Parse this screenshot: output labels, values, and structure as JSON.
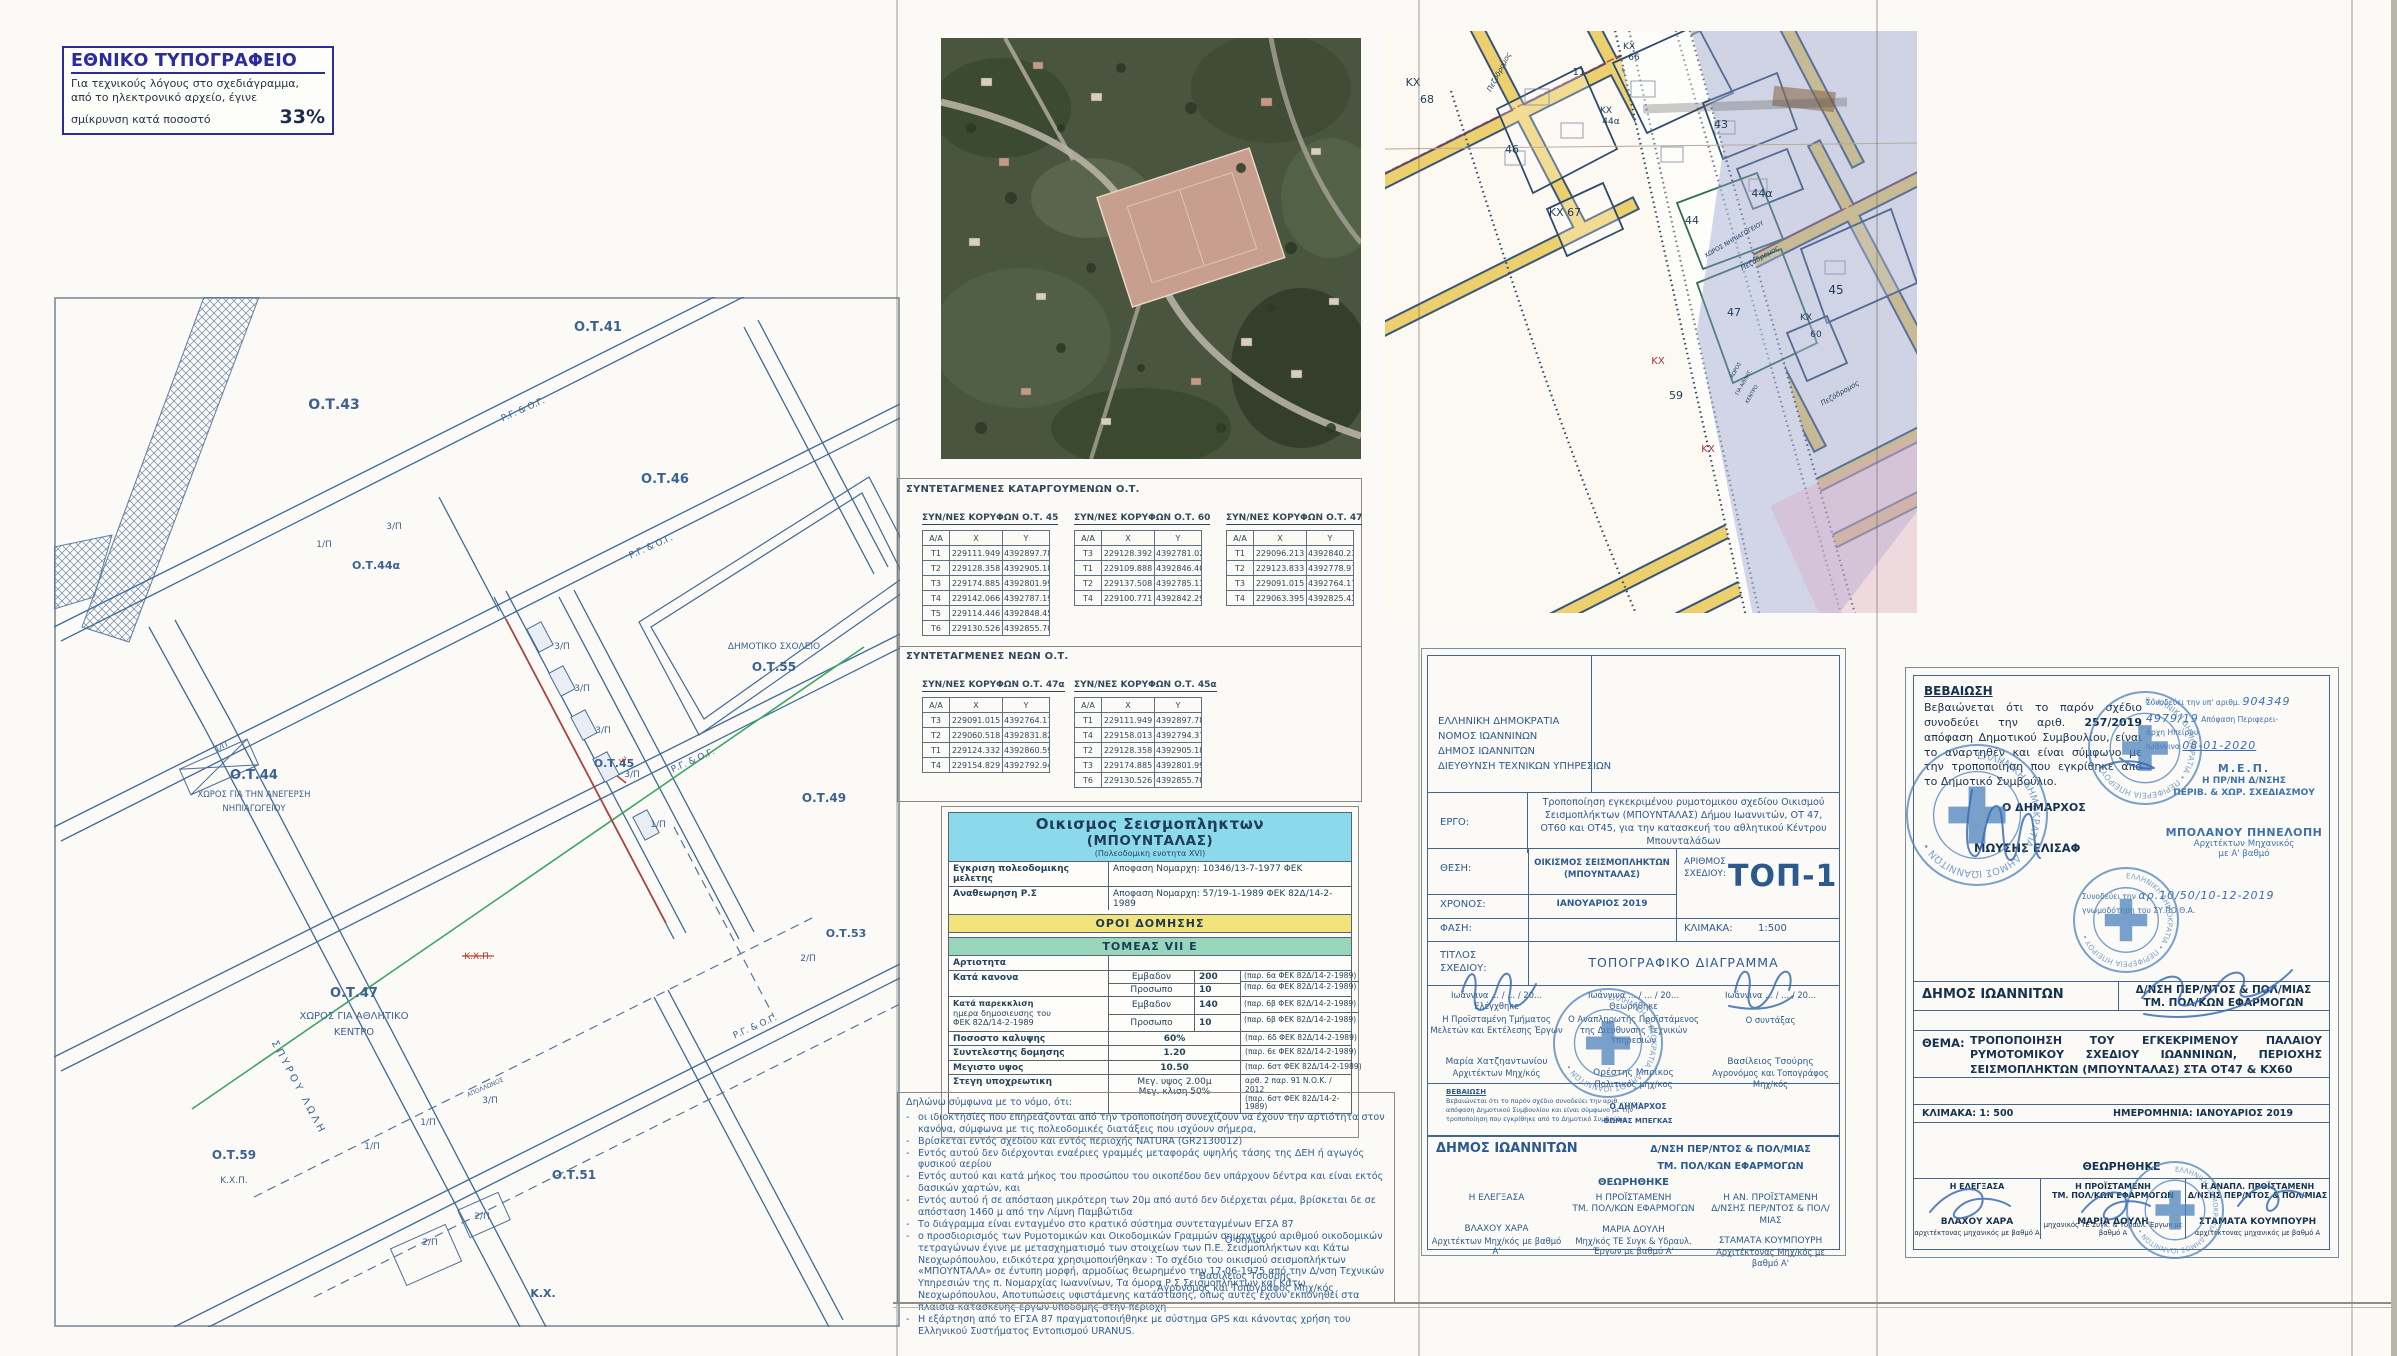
{
  "colors": {
    "ink_blue": "#2d5a8e",
    "drawing_line": "#3f6a96",
    "navy": "#16324f",
    "stamp_blue": "#4d83bd",
    "band_cyan": "#8bd9ea",
    "band_yellow": "#f3e37b",
    "band_green": "#97d6ba",
    "accent_red": "#c0392f",
    "old_map_road_yellow": "#ecd06e",
    "old_map_wash_blue": "#8f9ccc",
    "aerial_green": "#49553e"
  },
  "stamp_note": {
    "title": "ΕΘΝΙΚΟ ΤΥΠΟΓΡΑΦΕΙΟ",
    "line1": "Για τεχνικούς λόγους στο σχεδιάγραμμα,",
    "line2": "από το ηλεκτρονικό αρχείο, έγινε",
    "line3": "σμίκρυνση κατά ποσοστό",
    "percent": "33%"
  },
  "map_left": {
    "labels": [
      {
        "t": "Ο.Τ.43",
        "x": 280,
        "y": 112,
        "s": 14,
        "b": 1
      },
      {
        "t": "Ο.Τ.41",
        "x": 544,
        "y": 34,
        "s": 13,
        "b": 1
      },
      {
        "t": "Ο.Τ.46",
        "x": 611,
        "y": 186,
        "s": 13,
        "b": 1
      },
      {
        "t": "Ο.Τ.44α",
        "x": 322,
        "y": 272,
        "s": 11,
        "b": 1
      },
      {
        "t": "1/Π",
        "x": 270,
        "y": 250,
        "s": 9
      },
      {
        "t": "3/Π",
        "x": 340,
        "y": 232,
        "s": 9
      },
      {
        "t": "Ρ.Γ. & Ο.Γ.",
        "x": 470,
        "y": 115,
        "s": 9,
        "r": -24
      },
      {
        "t": "Ρ.Γ. & Ο.Γ.",
        "x": 598,
        "y": 252,
        "s": 9,
        "r": -24
      },
      {
        "t": "Ρ.Γ. & Ο.Γ.",
        "x": 640,
        "y": 466,
        "s": 9,
        "r": -24
      },
      {
        "t": "Ρ.Γ. & Ο.Γ.",
        "x": 702,
        "y": 732,
        "s": 9,
        "r": -24
      },
      {
        "t": "Ο.Τ.44",
        "x": 200,
        "y": 482,
        "s": 13,
        "b": 1
      },
      {
        "t": "ΧΩΡΟΣ ΓΙΑ ΤΗΝ ΑΝΕΓΕΡΣΗ",
        "x": 200,
        "y": 500,
        "s": 8.5
      },
      {
        "t": "ΝΗΠΙΑΓΩΓΕΙΟΥ",
        "x": 200,
        "y": 514,
        "s": 8.5
      },
      {
        "t": "1/Π",
        "x": 168,
        "y": 452,
        "s": 8,
        "r": -24
      },
      {
        "t": "Ο.Τ.45",
        "x": 560,
        "y": 470,
        "s": 11,
        "b": 1
      },
      {
        "t": "3/Π",
        "x": 508,
        "y": 352,
        "s": 9
      },
      {
        "t": "3/Π",
        "x": 528,
        "y": 394,
        "s": 9
      },
      {
        "t": "3/Π",
        "x": 549,
        "y": 436,
        "s": 9
      },
      {
        "t": "3/Π",
        "x": 578,
        "y": 480,
        "s": 9
      },
      {
        "t": "1/Π",
        "x": 604,
        "y": 530,
        "s": 9
      },
      {
        "t": "ΔΗΜΟΤΙΚΟ ΣΧΟΛΕΙΟ",
        "x": 720,
        "y": 352,
        "s": 9
      },
      {
        "t": "Ο.Τ.55",
        "x": 720,
        "y": 374,
        "s": 12,
        "b": 1
      },
      {
        "t": "Ο.Τ.49",
        "x": 770,
        "y": 505,
        "s": 12,
        "b": 1
      },
      {
        "t": "Ο.Τ.47",
        "x": 300,
        "y": 700,
        "s": 13,
        "b": 1
      },
      {
        "t": "ΧΩΡΟΣ ΓΙΑ ΑΘΛΗΤΙΚΟ",
        "x": 300,
        "y": 722,
        "s": 10
      },
      {
        "t": "ΚΕΝΤΡΟ",
        "x": 300,
        "y": 738,
        "s": 10
      },
      {
        "t": "Κ.Χ.Π.",
        "x": 424,
        "y": 662,
        "s": 9,
        "c": "#c0392f",
        "strike": 1
      },
      {
        "t": "3",
        "x": 566,
        "y": 464,
        "s": 9,
        "c": "#c0392f",
        "r": 62
      },
      {
        "t": "Ο.Τ.53",
        "x": 792,
        "y": 640,
        "s": 11,
        "b": 1
      },
      {
        "t": "2/Π",
        "x": 754,
        "y": 664,
        "s": 9
      },
      {
        "t": "Ο.Τ.51",
        "x": 520,
        "y": 882,
        "s": 12,
        "b": 1
      },
      {
        "t": "Ο.Τ.59",
        "x": 180,
        "y": 862,
        "s": 12,
        "b": 1
      },
      {
        "t": "Κ.Χ.Π.",
        "x": 180,
        "y": 886,
        "s": 9
      },
      {
        "t": "ΣΠΥΡΟΥ ΛΩΛΗ",
        "x": 242,
        "y": 792,
        "s": 10,
        "r": 62,
        "ls": 3
      },
      {
        "t": "ΑΠΟΛΛΩΝΟΣ",
        "x": 432,
        "y": 792,
        "s": 6,
        "r": -24
      },
      {
        "t": "1/Π",
        "x": 318,
        "y": 852,
        "s": 9
      },
      {
        "t": "1/Π",
        "x": 374,
        "y": 828,
        "s": 9
      },
      {
        "t": "3/Π",
        "x": 436,
        "y": 806,
        "s": 9
      },
      {
        "t": "2/Π",
        "x": 376,
        "y": 948,
        "s": 9
      },
      {
        "t": "2/Π",
        "x": 428,
        "y": 922,
        "s": 9
      },
      {
        "t": "Κ.Χ.",
        "x": 489,
        "y": 1000,
        "s": 11,
        "b": 1
      }
    ]
  },
  "map_old": {
    "labels": [
      {
        "t": "ΚΧ",
        "x": 28,
        "y": 55,
        "s": 11
      },
      {
        "t": "68",
        "x": 42,
        "y": 72,
        "s": 11
      },
      {
        "t": "ΚΧ",
        "x": 244,
        "y": 18,
        "s": 9
      },
      {
        "t": "66",
        "x": 249,
        "y": 29,
        "s": 9
      },
      {
        "t": "11",
        "x": 194,
        "y": 44,
        "s": 10
      },
      {
        "t": "ΚΧ",
        "x": 221,
        "y": 82,
        "s": 9
      },
      {
        "t": "44α",
        "x": 226,
        "y": 93,
        "s": 9
      },
      {
        "t": "43",
        "x": 336,
        "y": 97,
        "s": 11
      },
      {
        "t": "46",
        "x": 127,
        "y": 122,
        "s": 11
      },
      {
        "t": "ΚΧ 67",
        "x": 180,
        "y": 185,
        "s": 11
      },
      {
        "t": "44α",
        "x": 377,
        "y": 166,
        "s": 11
      },
      {
        "t": "44",
        "x": 307,
        "y": 193,
        "s": 11
      },
      {
        "t": "ΧΩΡΟΣ ΝΗΠΙΑΓΩΓΕΙΟΥ",
        "x": 350,
        "y": 210,
        "s": 6,
        "r": -30
      },
      {
        "t": "Πεζόδρομος",
        "x": 116,
        "y": 42,
        "s": 7,
        "r": -62,
        "i": 1
      },
      {
        "t": "Πεζόδρομος",
        "x": 376,
        "y": 229,
        "s": 7,
        "r": -30,
        "i": 1
      },
      {
        "t": "Πεζόδρομος",
        "x": 456,
        "y": 364,
        "s": 7,
        "r": -30,
        "i": 1
      },
      {
        "t": "45",
        "x": 451,
        "y": 263,
        "s": 12
      },
      {
        "t": "47",
        "x": 349,
        "y": 285,
        "s": 11
      },
      {
        "t": "ΚΧ",
        "x": 273,
        "y": 333,
        "s": 10,
        "c": "#a83240"
      },
      {
        "t": "59",
        "x": 291,
        "y": 368,
        "s": 11
      },
      {
        "t": "ΚΧ",
        "x": 323,
        "y": 421,
        "s": 10,
        "c": "#a83240"
      },
      {
        "t": "ΚΧ",
        "x": 421,
        "y": 289,
        "s": 9
      },
      {
        "t": "60",
        "x": 431,
        "y": 306,
        "s": 9
      },
      {
        "t": "ΧΩΡΟΣ",
        "x": 352,
        "y": 340,
        "s": 5,
        "r": -60
      },
      {
        "t": "ΓΙΑ ΑΘΛΗΤ.",
        "x": 360,
        "y": 352,
        "s": 5,
        "r": -60
      },
      {
        "t": "ΚΕΝΤΡΟ",
        "x": 368,
        "y": 364,
        "s": 5,
        "r": -60
      }
    ]
  },
  "coords": {
    "title_removed": "ΣΥΝΤΕΤΑΓΜΕΝΕΣ ΚΑΤΑΡΓΟΥΜΕΝΩΝ Ο.Τ.",
    "title_new": "ΣΥΝΤΕΤΑΓΜΕΝΕΣ ΝΕΩΝ Ο.Τ.",
    "headers": [
      "Α/Α",
      "Χ",
      "Υ"
    ],
    "removed": [
      {
        "title": "ΣΥΝ/ΝΕΣ ΚΟΡΥΦΩΝ Ο.Τ. 45",
        "rows": [
          [
            "Τ1",
            "229111.949",
            "4392897.789"
          ],
          [
            "Τ2",
            "229128.358",
            "4392905.187"
          ],
          [
            "Τ3",
            "229174.885",
            "4392801.991"
          ],
          [
            "Τ4",
            "229142.066",
            "4392787.194"
          ],
          [
            "Τ5",
            "229114.446",
            "4392848.455"
          ],
          [
            "Τ6",
            "229130.526",
            "4392855.705"
          ]
        ]
      },
      {
        "title": "ΣΥΝ/ΝΕΣ ΚΟΡΥΦΩΝ Ο.Τ. 60",
        "rows": [
          [
            "Τ3",
            "229128.392",
            "4392781.029"
          ],
          [
            "Τ1",
            "229109.888",
            "4392846.400"
          ],
          [
            "Τ2",
            "229137.508",
            "4392785.139"
          ],
          [
            "Τ4",
            "229100.771",
            "4392842.290"
          ]
        ]
      },
      {
        "title": "ΣΥΝ/ΝΕΣ ΚΟΡΥΦΩΝ Ο.Τ. 47",
        "rows": [
          [
            "Τ1",
            "229096.213",
            "4392840.235"
          ],
          [
            "Τ2",
            "229123.833",
            "4392778.974"
          ],
          [
            "Τ3",
            "229091.015",
            "4392764.177"
          ],
          [
            "Τ4",
            "229063.395",
            "4392825.439"
          ]
        ]
      }
    ],
    "new": [
      {
        "title": "ΣΥΝ/ΝΕΣ ΚΟΡΥΦΩΝ Ο.Τ. 47α",
        "rows": [
          [
            "Τ3",
            "229091.015",
            "4392764.177"
          ],
          [
            "Τ2",
            "229060.518",
            "4392831.820"
          ],
          [
            "Τ1",
            "229124.332",
            "4392860.591"
          ],
          [
            "Τ4",
            "229154.829",
            "4392792.948"
          ]
        ]
      },
      {
        "title": "ΣΥΝ/ΝΕΣ ΚΟΡΥΦΩΝ Ο.Τ. 45α",
        "rows": [
          [
            "Τ1",
            "229111.949",
            "4392897.789"
          ],
          [
            "Τ4",
            "229158.013",
            "4392794.376"
          ],
          [
            "Τ2",
            "229128.358",
            "4392905.187"
          ],
          [
            "Τ3",
            "229174.885",
            "4392801.991"
          ],
          [
            "Τ6",
            "229130.526",
            "4392855.705"
          ]
        ]
      }
    ]
  },
  "oroi": {
    "title1": "Οικισμος Σεισμοπληκτων",
    "title2": "(ΜΠΟΥΝΤΑΛΑΣ)",
    "title3": "(Πολεοδομικη ενοτητα XVI)",
    "appr1_label": "Εγκριση πολεοδομικης μελετης",
    "appr1_value": "Αποφαση Νομαρχη: 10346/13-7-1977  ΦΕΚ",
    "appr2_label": "Αναθεωρηση Ρ.Σ",
    "appr2_value": "Αποφαση Νομαρχη: 57/19-1-1989  ΦΕΚ 82Δ/14-2-1989",
    "band_terms": "ΟΡΟΙ ΔΟΜΗΣΗΣ",
    "band_sector": "ΤΟΜΕΑΣ  VII Ε",
    "artiotita": "Αρτιοτητα",
    "kanona_label": "Κατά  κανονα",
    "kan_r1": [
      "Εμβαδον",
      "200",
      "(παρ. 6α ΦΕΚ 82Δ/14-2-1989)"
    ],
    "kan_r2": [
      "Προσωπο",
      "10",
      "(παρ. 6α ΦΕΚ 82Δ/14-2-1989)"
    ],
    "par_label1": "Κατά  παρεκκλιση",
    "par_label2": "ημερα δημοσιευσης του",
    "par_label3": "ΦΕΚ  82Δ/14-2-1989",
    "par_r1": [
      "Εμβαδον",
      "140",
      "(παρ. 6β ΦΕΚ 82Δ/14-2-1989)"
    ],
    "par_r2": [
      "Προσωπο",
      "10",
      "(παρ. 6β ΦΕΚ 82Δ/14-2-1989)"
    ],
    "row_cover": [
      "Ποσοστο καλυψης",
      "60%",
      "(παρ. 6δ ΦΕΚ 82Δ/14-2-1989)"
    ],
    "row_sd": [
      "Συντελεστης  δομησης",
      "1.20",
      "(παρ. 6ε ΦΕΚ 82Δ/14-2-1989)"
    ],
    "row_height": [
      "Μεγιστο υψος",
      "10.50",
      "(παρ. 6στ ΦΕΚ 82Δ/14-2-1989)"
    ],
    "roof_label": "Στεγη υποχρεωτικη",
    "roof_mid1": "Μεγ.  υψος 2.00μ",
    "roof_mid2": "Μεγ.  κλιση  50%",
    "roof_cite1": "αρθ. 2  παρ. 91 Ν.Ο.Κ. / 2012",
    "roof_cite2": "(παρ. 6στ ΦΕΚ 82Δ/14-2-1989)"
  },
  "declaration": {
    "intro": "Δηλώνω σύμφωνα με το νόμο, ότι:",
    "bullets": [
      "οι ιδιοκτησίες που επηρεάζονται από την τροποποίηση συνεχίζουν να έχουν την αρτιότητα στον κανόνα, σύμφωνα με τις πολεοδομικές διατάξεις που ισχύουν σήμερα,",
      "Βρίσκεται εντός σχεδίου και εντός περιοχής NATURA (GR2130012)",
      "Εντός αυτού δεν διέρχονται εναέριες γραμμές μεταφοράς υψηλής τάσης της ΔΕΗ ή αγωγός φυσικού αερίου",
      "Εντός αυτού και κατά μήκος του προσώπου του οικοπέδου δεν υπάρχουν δέντρα και είναι εκτός δασικών χαρτών, και",
      "Εντός αυτού ή σε απόσταση μικρότερη των 20μ από αυτό δεν διέρχεται ρέμα, βρίσκεται δε σε απόσταση 1460 μ από την Λίμνη Παμβώτιδα",
      "Το διάγραμμα είναι ενταγμένο στο κρατικό σύστημα συντεταγμένων ΕΓΣΑ 87",
      "ο προσδιορισμός των Ρυμοτομικών και Οικοδομικών Γραμμών σημαντικού αριθμού οικοδομικών τετραγώνων έγινε με μετασχηματισμό των στοιχείων των Π.Ε. Σεισμοπλήκτων και Κάτω Νεοχωρόπουλου, ειδικότερα χρησιμοποιήθηκαν : Το σχέδιο του οικισμού σεισμοπλήκτων «ΜΠΟΥΝΤΑΛΑ» σε έντυπη μορφή, αρμοδίως θεωρημένο την 17-06-1975 από την Δ/νση Τεχνικών Υπηρεσιών της π. Νομαρχίας Ιωαννίνων, Τα όμορα Ρ.Σ Σεισμοπλήκτων και Κάτω Νεοχωρόπουλου, Αποτυπώσεις υφιστάμενης κατάστασης, όπως αυτές έχουν εκπονηθεί στα πλαίσια κατασκευής έργων υποδομής στην περιοχή",
      "Η εξάρτηση από το ΕΓΣΑ 87 πραγματοποιήθηκε με σύστημα GPS και κάνοντας χρήση του Ελληνικού Συστήματος Εντοπισμού URANUS."
    ],
    "signoff": "Ο δηλών",
    "signer_name": "Βασιλειος Τσούρης",
    "signer_title": "Αγρονόμος και Τοπογράφος   Μηχ/κός"
  },
  "titleblock": {
    "agency0": "ΕΛΛΗΝΙΚΗ ΔΗΜΟΚΡΑΤΙΑ",
    "agency1": "ΝΟΜΟΣ ΙΩΑΝΝΙΝΩΝ",
    "agency2": "ΔΗΜΟΣ ΙΩΑΝΝΙΤΩΝ",
    "agency3": "ΔΙΕΥΘΥΝΣΗ ΤΕΧΝΙΚΩΝ ΥΠΗΡΕΣΙΩΝ",
    "ergo_label": "ΕΡΓΟ:",
    "ergo_text": "Τροποποίηση εγκεκριμένου ρυμοτομικου σχεδίου Οικισμού Σεισμοπλήκτων (ΜΠΟΥΝΤΑΛΑΣ) Δήμου Ιωαννιτών, ΟΤ 47, ΟΤ60 και ΟΤ45, για την κατασκευή του αθλητικού Κέντρου Μπουνταλάδων",
    "thesi_label": "ΘΕΣΗ:",
    "thesi_text1": "ΟΙΚΙΣΜΟΣ ΣΕΙΣΜΟΠΛΗΚΤΩΝ",
    "thesi_text2": "(ΜΠΟΥΝΤΑΛΑΣ)",
    "num_label1": "ΑΡΙΘΜΟΣ",
    "num_label2": "ΣΧΕΔΙΟΥ:",
    "num_value": "ΤΟΠ-1",
    "xronos_label": "ΧΡΟΝΟΣ:",
    "xronos_value": "ΙΑΝΟΥΑΡΙΟΣ 2019",
    "fasi_label": "ΦΑΣΗ:",
    "klimaka_label": "ΚΛΙΜΑΚΑ:",
    "klimaka_value": "1:500",
    "titlos_label1": "ΤΙΤΛΟΣ",
    "titlos_label2": "ΣΧΕΔΙΟΥ:",
    "titlos_value": "ΤΟΠΟΓΡΑΦΙΚΟ ΔΙΑΓΡΑΜΜΑ",
    "sig_cols": [
      {
        "place": "Ιωάννινα  ... / ... / 20...",
        "status": "Ελέγχθηκε",
        "role1": "Η Προϊσταμένη Τμήματος",
        "role2": "Μελετών και Εκτέλεσης Έργων",
        "name": "Μαρία Χατζηαντωνίου",
        "title": "Αρχιτέκτων  Μηχ/κός"
      },
      {
        "place": "Ιωάννινα  ... / ... / 20...",
        "status": "Θεωρήθηκε",
        "role1": "Ο Αναπληρωτής Προϊστάμενος",
        "role2": "της Διεύθυνσης Τεχνικών Υπηρεσιών",
        "name": "Ορέστης Μπρίκος",
        "title": "Πολιτικός  μηχ/κος"
      },
      {
        "place": "Ιωάννινα  ... / ... / 20...",
        "status": "",
        "role1": "",
        "role2": "Ο συντάξας",
        "name": "Βασίλειος Τσούρης",
        "title": "Αγρονόμος και Τοπογράφος Μηχ/κός"
      }
    ],
    "vev_small_title": "ΒΕΒΑΙΩΣΗ",
    "vev_small_l1": "Βεβαιώνεται ότι το παρόν σχέδιο συνοδεύει την αριθ. ..........",
    "vev_small_l2": "απόφαση Δημοτικού Συμβουλίου και είναι σύμφωνο με την",
    "vev_small_l3": "τροποποίηση που εγκρίθηκε από το Δημοτικό Συμβούλιο.",
    "vev_small_mayor": "Ο ΔΗΜΑΡΧΟΣ",
    "vev_small_mayor_name": "ΘΩΜΑΣ ΜΠΕΓΚΑΣ",
    "muni": "ΔΗΜΟΣ ΙΩΑΝΝΙΤΩΝ",
    "muni_r1": "Δ/ΝΣΗ ΠΕΡ/ΝΤΟΣ & ΠΟΛ/ΜΙΑΣ",
    "muni_r2": "ΤΜ. ΠΟΛ/ΚΩΝ ΕΦΑΡΜΟΓΩΝ",
    "approved": "ΘΕΩΡΗΘΗΚΕ",
    "appr_cols": [
      {
        "role1": "Η ΕΛΕΓΞΑΣΑ",
        "role2": "",
        "name": "ΒΛΑΧΟΥ ΧΑΡΑ",
        "title": "Αρχιτέκτων  Μηχ/κός με βαθμό Α'"
      },
      {
        "role1": "Η ΠΡΟΪΣΤΑΜΕΝΗ",
        "role2": "ΤΜ. ΠΟΛ/ΚΩΝ  ΕΦΑΡΜΟΓΩΝ",
        "name": "ΜΑΡΙΑ ΔΟΥΛΗ",
        "title": "Μηχ/κός ΤΕ Συγκ & Υδραυλ. Έργων με βαθμό Α'"
      },
      {
        "role1": "Η ΑΝ. ΠΡΟΪΣΤΑΜΕΝΗ",
        "role2": "Δ/ΝΣΗΣ ΠΕΡ/ΝΤΟΣ & ΠΟΛ/ΜΙΑΣ",
        "name": "ΣΤΑΜΑΤΑ ΚΟΥΜΠΟΥΡΗ",
        "title": "Αρχιτέκτονας  Μηχ/κός με βαθμό Α'"
      }
    ]
  },
  "rightblock": {
    "vev_title": "ΒΕΒΑΙΩΣΗ",
    "vev_text_pre": "Βεβαιώνεται ότι το παρόν σχέδιο συνοδεύει την αριθ. ",
    "vev_num": "257/2019",
    "vev_text_post": " απόφαση Δημοτικού Συμβουλίου, είναι το αναρτηθέν και είναι σύμφωνο με την τροποποίηση που εγκρίθηκε από το Δημοτικό Συμβούλιο.",
    "mayor_label": "Ο ΔΗΜΑΡΧΟΣ",
    "mayor_name": "ΜΩΥΣΗΣ  ΕΛΙΣΑΦ",
    "note1_pre": "Συνοδεύει την υπ' αριθμ.",
    "note1_hand": "904349",
    "note1_hand2": "4979/19",
    "note1_mid": "Απόφαση Περιφερει-",
    "note1_mid2": "άρχη Ηπείρου",
    "note1_city": "Ιωάννινα",
    "note1_date": "08-01-2020",
    "mep1": "Μ.Ε.Π.",
    "mep2": "Η ΠΡ/ΝΗ Δ/ΝΣΗΣ",
    "mep3": "ΠΕΡΙΒ. & ΧΩΡ. ΣΧΕΔΙΑΣΜΟΥ",
    "arch_name": "ΜΠΟΛΑΝΟΥ ΠΗΝΕΛΟΠΗ",
    "arch_title1": "Αρχιτέκτων Μηχανικός",
    "arch_title2": "με Α' βαθμό",
    "note2_pre": "Συνοδεύει την",
    "note2_hand": "αρ.10/50/10-12-2019",
    "note2_post": "γνωμοδότηση του ΣΥ.ΠΟ.Θ.Α.",
    "dept_left": "ΔΗΜΟΣ ΙΩΑΝΝΙΤΩΝ",
    "dept_right1": "Δ/ΝΣΗ ΠΕΡ/ΝΤΟΣ & ΠΟΛ/ΜΙΑΣ",
    "dept_right2": "ΤΜ. ΠΟΛ/ΚΩΝ ΕΦΑΡΜΟΓΩΝ",
    "thema_label": "ΘΕΜΑ:",
    "thema_text": "ΤΡΟΠΟΠΟΙΗΣΗ ΤΟΥ ΕΓΚΕΚΡΙΜΕΝΟΥ ΠΑΛΑΙΟΥ ΡΥΜΟΤΟΜΙΚΟΥ ΣΧΕΔΙΟΥ ΙΩΑΝΝΙΝΩΝ, ΠΕΡΙΟΧΗΣ ΣΕΙΣΜΟΠΛΗΚΤΩΝ (ΜΠΟΥΝΤΑΛΑΣ) ΣΤΑ ΟΤ47 & ΚΧ60",
    "scale": "ΚΛΙΜΑΚΑ: 1: 500",
    "date": "ΗΜΕΡΟΜΗΝΙΑ: ΙΑΝΟΥΑΡΙΟΣ 2019",
    "approved": "ΘΕΩΡΗΘΗΚΕ",
    "cols": [
      {
        "role1": "Η ΕΛΕΓΞΑΣΑ",
        "role2": "",
        "name": "ΒΛΑΧΟΥ ΧΑΡΑ",
        "title": "αρχιτέκτονας μηχανικός με βαθμό Α"
      },
      {
        "role1": "Η ΠΡΟΪΣΤΑΜΕΝΗ",
        "role2": "ΤΜ. ΠΟΛ/ΚΩΝ ΕΦΑΡΜΟΓΩΝ",
        "name": "ΜΑΡΙΑ ΔΟΥΛΗ",
        "title": "μηχανικός ΤΕ Συγκ. & Υδραυλ. Έργων με βαθμό Α"
      },
      {
        "role1": "Η ΑΝΑΠΛ. ΠΡΟΪΣΤΑΜΕΝΗ",
        "role2": "Δ/ΝΣΗΣ ΠΕΡ/ΝΤΟΣ & ΠΟΛ/ΜΙΑΣ",
        "name": "ΣΤΑΜΑΤΑ ΚΟΥΜΠΟΥΡΗ",
        "title": "αρχιτέκτονας μηχανικός με βαθμό Α"
      }
    ]
  },
  "stamps": [
    {
      "x": 1608,
      "y": 1043,
      "r": 54,
      "text": "ΕΛΛΗΝΙΚΗ ΔΗΜΟΚΡΑΤΙΑ • ΔΗΜΟΣ ΙΩΑΝΝΙΤΩΝ •"
    },
    {
      "x": 1977,
      "y": 815,
      "r": 70,
      "text": "ΕΛΛΗΝΙΚΗ ΔΗΜΟΚΡΑΤΙΑ • ΔΗΜΟΣ ΙΩΑΝΝΙΤΩΝ •"
    },
    {
      "x": 2145,
      "y": 748,
      "r": 56,
      "text": "ΕΛΛΗΝΙΚΗ ΔΗΜΟΚΡΑΤΙΑ • ΠΕΡΙΦΕΡΕΙΑ ΗΠΕΙΡΟΥ •"
    },
    {
      "x": 2126,
      "y": 920,
      "r": 52,
      "text": "ΕΛΛΗΝΙΚΗ ΔΗΜΟΚΡΑΤΙΑ • ΠΕΡΙΦΕΡΕΙΑ ΗΠΕΙΡΟΥ •"
    },
    {
      "x": 2175,
      "y": 1210,
      "r": 48,
      "text": "ΕΛΛΗΝΙΚΗ ΔΗΜΟΚΡΑΤΙΑ • ΔΗΜΟΣ ΙΩΑΝΝΙΤΩΝ •"
    }
  ]
}
